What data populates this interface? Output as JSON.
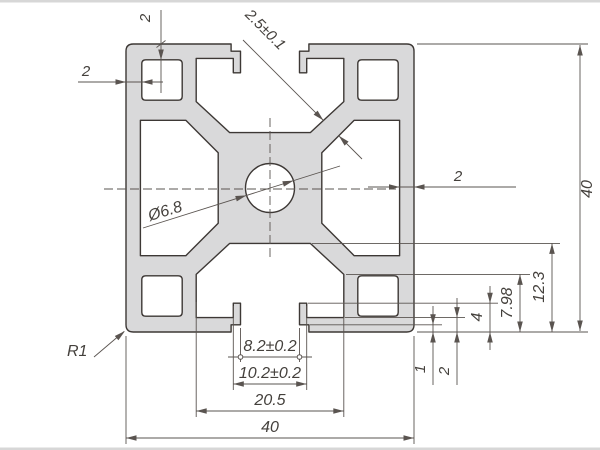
{
  "drawing": {
    "type": "technical-cross-section",
    "subject": "40x40 aluminium extrusion profile",
    "colors": {
      "background": "#ffffff",
      "profile_fill": "#d9d9da",
      "outline": "#3d3835",
      "dimension": "#5a5450"
    },
    "dimensions": {
      "top_wall": "2",
      "left_wall": "2",
      "lip_thickness": "2.5±0.1",
      "right_wall": "2",
      "height": "40",
      "slot_depth": "12.3",
      "channel_height": "7.98",
      "step_depth": "4",
      "lip_depth": "2",
      "notch_depth": "1",
      "center_hole": "Ø6.8",
      "corner_radius": "R1",
      "slot_opening": "8.2±0.2",
      "slot_recess": "10.2±0.2",
      "cavity_width": "20.5",
      "width": "40"
    }
  }
}
